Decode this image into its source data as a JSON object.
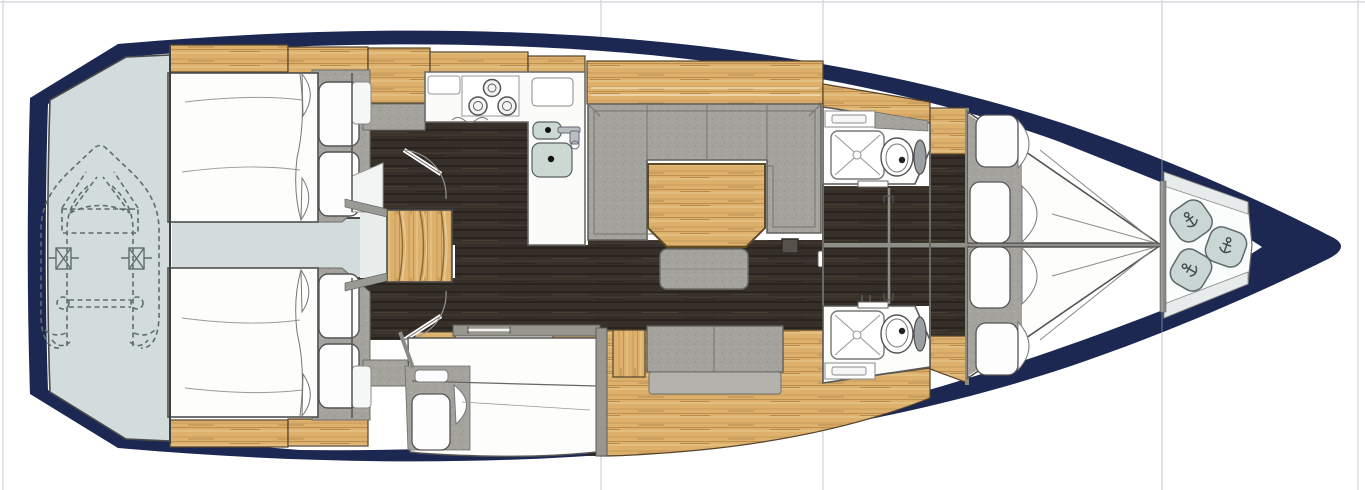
{
  "page": {
    "background": "#ffffff",
    "grid": {
      "color": "#d5dbe1",
      "vertical_x": [
        3,
        601,
        823,
        1162,
        1358
      ],
      "horizontal_y": [
        2
      ],
      "overlay_vertical_x": [
        1162
      ]
    }
  },
  "plan": {
    "type": "yacht-interior-deck-plan",
    "orientation": "bow-right",
    "palette": {
      "bg": "#ffffff",
      "hull": "#1c2752",
      "platform": "#d2dcdc",
      "platform-light": "#e9eeec",
      "wood": "#ddb06c",
      "wood-line": "#55432a",
      "floor": "#37302a",
      "uphol": "#a4a39e",
      "uphol-dark": "#62615b",
      "bed": "#fdfdfc",
      "fixture": "#ccd9d2",
      "bag": "#c9d6d3",
      "wall": "#8b8b86",
      "grid": "#d5dbe1",
      "line": "#4a4a49",
      "tank": "#9aa0a2",
      "shelf": "#e7ebeb",
      "counter": "#fbfbfa"
    },
    "areas": [
      {
        "id": "hull",
        "name": "Hull outline, bow pointing right"
      },
      {
        "id": "swim-platform",
        "name": "Stern platform with dinghy stowage (dashed tender outline)"
      },
      {
        "id": "aft-cabin-port",
        "name": "Aft double cabin, port side"
      },
      {
        "id": "aft-cabin-starboard",
        "name": "Aft double cabin, starboard side"
      },
      {
        "id": "engine-passage",
        "name": "Engine compartment strip between aft cabins"
      },
      {
        "id": "companionway",
        "name": "Companionway steps"
      },
      {
        "id": "galley",
        "name": "L-shaped galley with 3-burner stove and twin sinks"
      },
      {
        "id": "salon",
        "name": "Salon with U-shaped sofa, table and stool"
      },
      {
        "id": "settee",
        "name": "Starboard settee bench"
      },
      {
        "id": "single-berth",
        "name": "Single berth compartment"
      },
      {
        "id": "head-port",
        "name": "Wet head with shower and toilet, port"
      },
      {
        "id": "head-starboard",
        "name": "Wet head with shower and toilet, starboard"
      },
      {
        "id": "forward-cabin",
        "name": "Forward V-berth double cabin"
      },
      {
        "id": "bow-locker",
        "name": "Bow sail locker with three gear bags"
      }
    ]
  }
}
